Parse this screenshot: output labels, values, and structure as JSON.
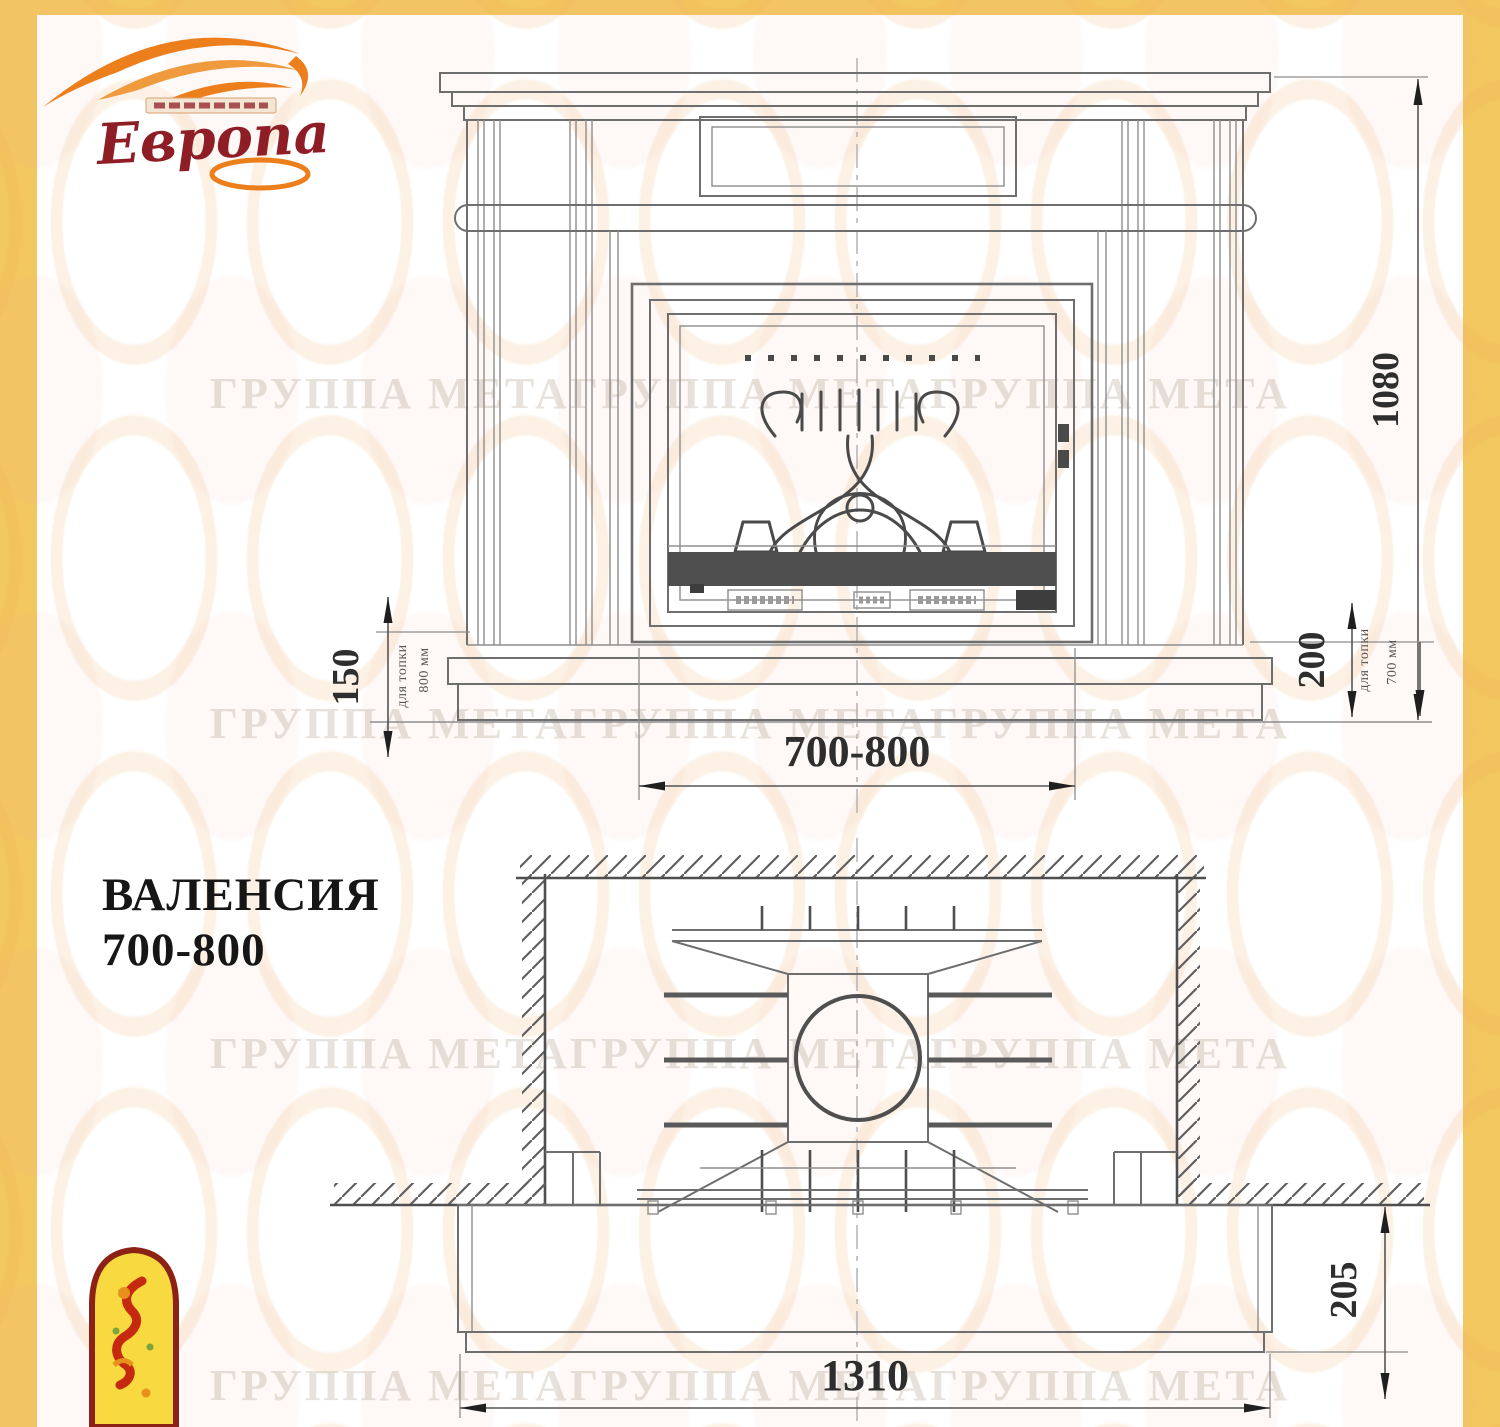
{
  "page": {
    "background_color": "#F3C75F",
    "panel_color": "#FFFFFF"
  },
  "logo": {
    "brand": "Европа",
    "flame_color": "#EC7E1C",
    "text_color": "#8E1D26"
  },
  "watermark": {
    "text": "ГРУППА МЕТАГРУППА МЕТАГРУППА МЕТА"
  },
  "title": {
    "line1": "ВАЛЕНСИЯ",
    "line2": "700-800"
  },
  "front_view": {
    "dim_total_height": "1080",
    "dim_hearth_left": "150",
    "dim_hearth_left_note_line1": "для топки",
    "dim_hearth_left_note_line2": "800 мм",
    "dim_hearth_right": "200",
    "dim_hearth_right_note_line1": "для топки",
    "dim_hearth_right_note_line2": "700 мм",
    "dim_opening_width": "700-800"
  },
  "plan_view": {
    "dim_base_depth": "205",
    "dim_base_width": "1310"
  }
}
